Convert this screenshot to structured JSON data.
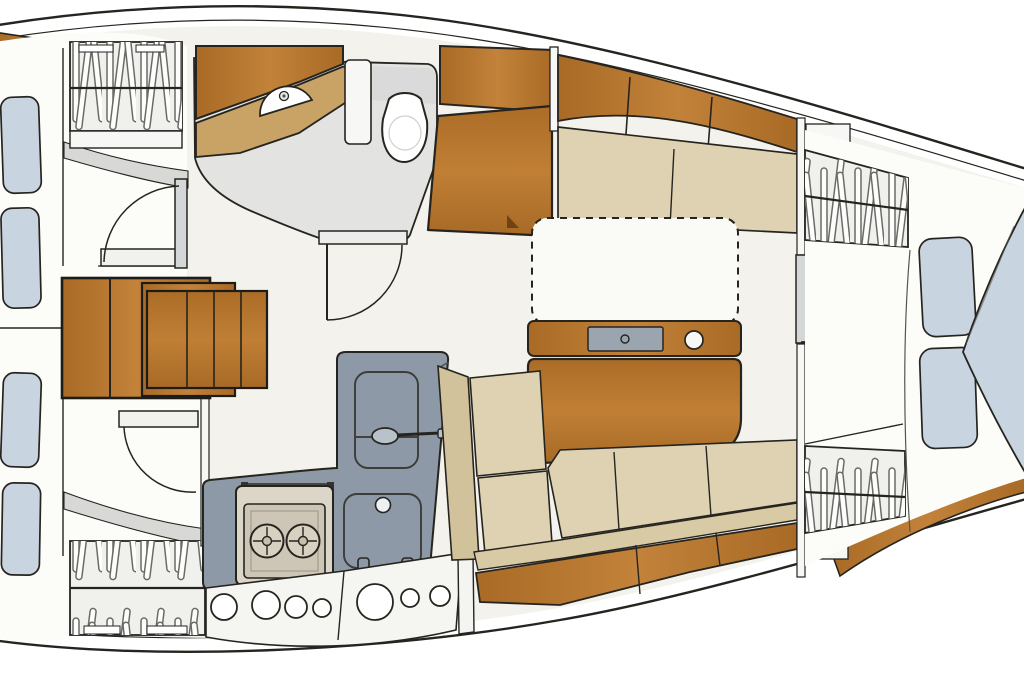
{
  "meta": {
    "label": "sailboat-interior-floor-plan",
    "canvas": {
      "width": 1024,
      "height": 680
    }
  },
  "palette": {
    "outline": "#26241f",
    "hull_white": "#ffffff",
    "floor": "#f3f2ec",
    "floor_light": "#fafaf7",
    "mattress": "#fcfcf9",
    "cushion_beige": "#ded2b2",
    "cushion_tan": "#d2c29c",
    "fiddle_tan": "#d8caa4",
    "pillow_blue": "#c8d4e0",
    "wood": "#b4722c",
    "wood_dark": "#9d6122",
    "counter_tan": "#c9a266",
    "galley_gray": "#8d99a6",
    "inset_gray": "#9aa5b0",
    "head_gray": "#e3e4e1",
    "wall_gray": "#d9dad9",
    "band_gray": "#d8d9d7",
    "fixture_white": "#f7f7f5",
    "locker_base": "#f0f0ed",
    "stove_frame": "#dcd6c9",
    "stove_panel": "#cdc6b6",
    "hanger_stroke": "#6a6a66",
    "door_gray": "#d4d7d8"
  },
  "inventory": {
    "rooms": [
      "aft-cabin-port",
      "aft-cabin-starboard",
      "head",
      "galley",
      "salon",
      "forward-cabin"
    ],
    "hanging_lockers": 4,
    "cabin_doors": 4,
    "companionway_step_tiers": 3,
    "settees": 2,
    "berth_pillows": 6,
    "portholes": 7,
    "stove_burners": 2,
    "galley_basins": 2,
    "vanity_sinks": 1,
    "toilets": 1,
    "salon_tables": 1
  }
}
